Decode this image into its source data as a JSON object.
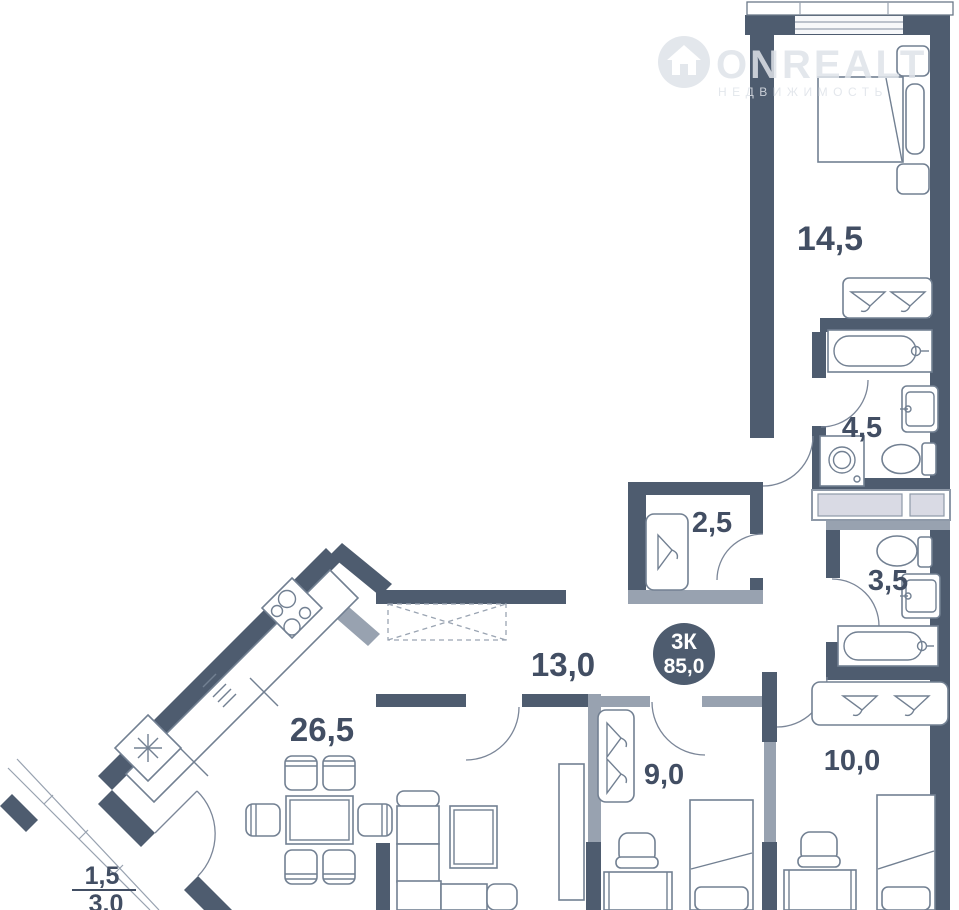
{
  "watermark": {
    "brand": "ONREALT",
    "subtitle": "НЕДВИЖИМОСТЬ"
  },
  "badge": {
    "type": "3К",
    "total_area": "85,0"
  },
  "rooms": {
    "bedroom": {
      "area": "14,5"
    },
    "bathroom_large": {
      "area": "4,5"
    },
    "closet": {
      "area": "2,5"
    },
    "bathroom_small": {
      "area": "3,5"
    },
    "hallway": {
      "area": "13,0"
    },
    "living_kitchen": {
      "area": "26,5"
    },
    "room_9": {
      "area": "9,0"
    },
    "room_10": {
      "area": "10,0"
    },
    "balcony": {
      "area_coefficient": "1,5",
      "area_full": "3,0"
    }
  },
  "colors": {
    "wall": "#4e5c6f",
    "partition": "#98a2b0",
    "furniture_stroke": "#728092",
    "label": "#424e63",
    "badge_bg": "#4e5c6f",
    "shaft_fill": "#d9dae4",
    "watermark": "#dfe3e9"
  }
}
